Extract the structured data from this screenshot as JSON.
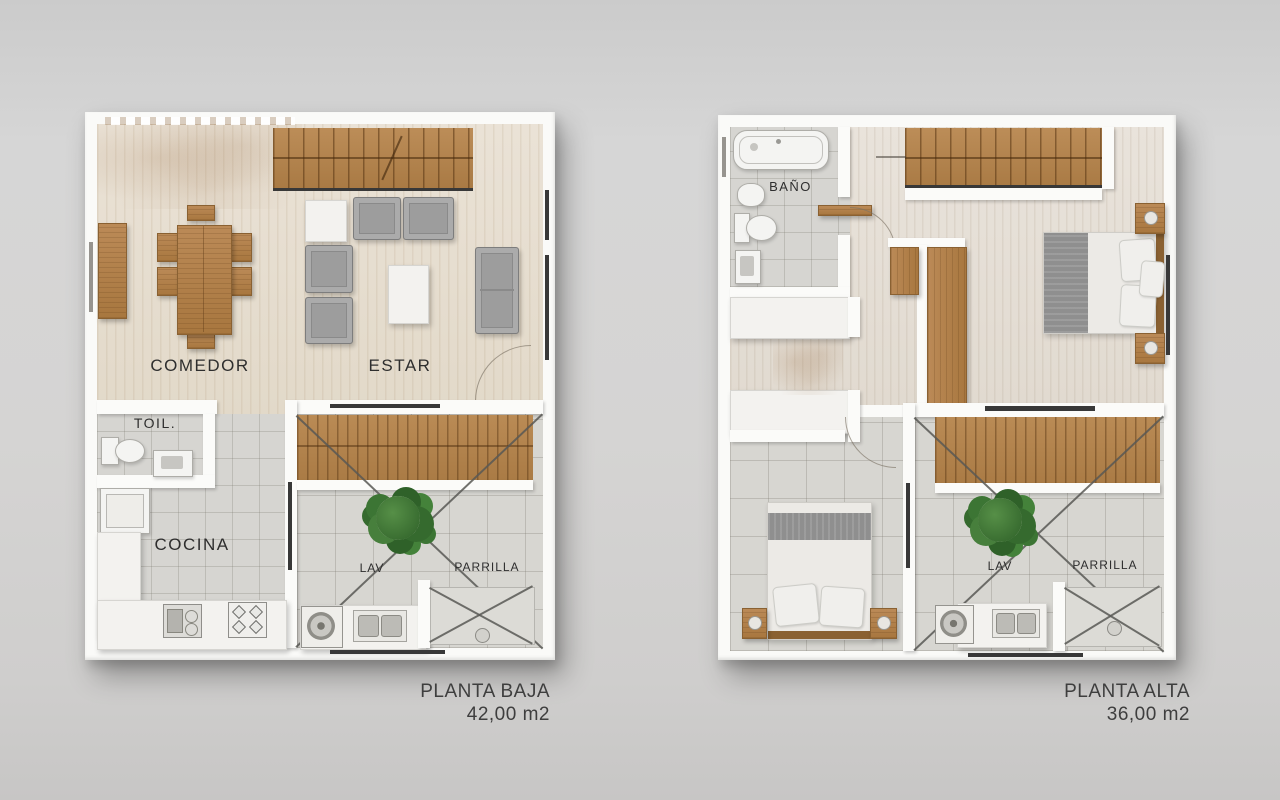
{
  "scene": {
    "background": "#d2d2d2"
  },
  "plans": [
    {
      "title": "PLANTA BAJA",
      "area": "42,00 m2",
      "labels": {
        "comedor": "COMEDOR",
        "estar": "ESTAR",
        "toil": "TOIL.",
        "cocina": "COCINA",
        "lav": "LAV",
        "parrilla": "PARRILLA"
      }
    },
    {
      "title": "PLANTA ALTA",
      "area": "36,00 m2",
      "labels": {
        "bano": "BAÑO",
        "lav": "LAV",
        "parrilla": "PARRILLA"
      }
    }
  ],
  "colors": {
    "background": "#d2d2d2",
    "wall": "#fafaf8",
    "wood_floor": "#e7dfd2",
    "whitewash_floor": "#e6e0d8",
    "tile_floor": "#d7d6d1",
    "stair_wood": "#b5854f",
    "furniture_wood": "#b3804e",
    "sofa_gray": "#9d9d9d",
    "tree_green": "#3f7a38",
    "label_text": "#2e2e2e",
    "caption_text": "#3e3e3e"
  }
}
